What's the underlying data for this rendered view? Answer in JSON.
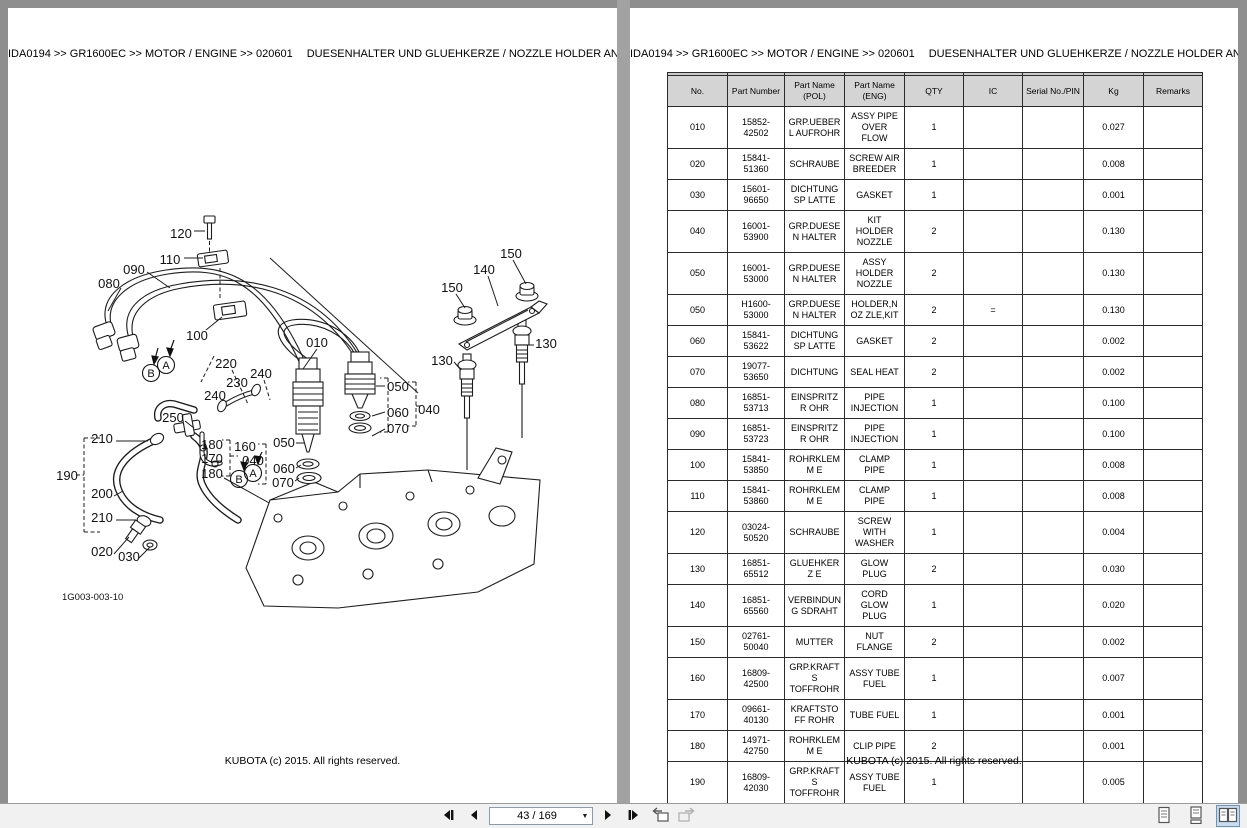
{
  "header": {
    "breadcrumb": "IDA0194 >> GR1600EC >> MOTOR / ENGINE >> 020601",
    "title": "DUESENHALTER UND GLUEHKERZE / NOZZLE HOLDER AND GLOW PLUG"
  },
  "footer": {
    "copyright": "KUBOTA (c) 2015. All rights reserved."
  },
  "diagram": {
    "figure_id": "1G003-003-10",
    "labels": [
      {
        "t": "120",
        "x": 173,
        "y": 225
      },
      {
        "t": "110",
        "x": 162,
        "y": 251
      },
      {
        "t": "090",
        "x": 126,
        "y": 261
      },
      {
        "t": "080",
        "x": 101,
        "y": 275
      },
      {
        "t": "100",
        "x": 189,
        "y": 327
      },
      {
        "t": "010",
        "x": 309,
        "y": 334
      },
      {
        "t": "150",
        "x": 503,
        "y": 245
      },
      {
        "t": "140",
        "x": 476,
        "y": 261
      },
      {
        "t": "150",
        "x": 444,
        "y": 279
      },
      {
        "t": "130",
        "x": 538,
        "y": 335
      },
      {
        "t": "130",
        "x": 434,
        "y": 352
      },
      {
        "t": "220",
        "x": 218,
        "y": 355
      },
      {
        "t": "240",
        "x": 253,
        "y": 365
      },
      {
        "t": "230",
        "x": 229,
        "y": 374
      },
      {
        "t": "240",
        "x": 207,
        "y": 387
      },
      {
        "t": "250",
        "x": 165,
        "y": 409
      },
      {
        "t": "210",
        "x": 94,
        "y": 430
      },
      {
        "t": "190",
        "x": 59,
        "y": 467
      },
      {
        "t": "200",
        "x": 94,
        "y": 485
      },
      {
        "t": "210",
        "x": 94,
        "y": 509
      },
      {
        "t": "020",
        "x": 94,
        "y": 543
      },
      {
        "t": "030",
        "x": 121,
        "y": 548
      },
      {
        "t": "180",
        "x": 204,
        "y": 436
      },
      {
        "t": "160",
        "x": 237,
        "y": 438
      },
      {
        "t": "170",
        "x": 204,
        "y": 450
      },
      {
        "t": "180",
        "x": 204,
        "y": 465
      },
      {
        "t": "040",
        "x": 245,
        "y": 452
      },
      {
        "t": "050",
        "x": 276,
        "y": 434
      },
      {
        "t": "060",
        "x": 276,
        "y": 460
      },
      {
        "t": "070",
        "x": 275,
        "y": 474
      },
      {
        "t": "050",
        "x": 390,
        "y": 378
      },
      {
        "t": "060",
        "x": 390,
        "y": 404
      },
      {
        "t": "040",
        "x": 421,
        "y": 401
      },
      {
        "t": "070",
        "x": 390,
        "y": 420
      },
      {
        "t": "A",
        "x": 158,
        "y": 357,
        "c": true
      },
      {
        "t": "B",
        "x": 143,
        "y": 365,
        "c": true
      },
      {
        "t": "A",
        "x": 245,
        "y": 465,
        "c": true
      },
      {
        "t": "B",
        "x": 231,
        "y": 471,
        "c": true
      }
    ]
  },
  "table": {
    "columns": [
      "No.",
      "Part Number",
      "Part Name (POL)",
      "Part Name (ENG)",
      "QTY",
      "IC",
      "Serial No./PIN",
      "Kg",
      "Remarks"
    ],
    "rows": [
      [
        "010",
        "15852-42502",
        "GRP.UEBERL AUFROHR",
        "ASSY PIPE OVER FLOW",
        "1",
        "",
        "",
        "0.027",
        ""
      ],
      [
        "020",
        "15841-51360",
        "SCHRAUBE",
        "SCREW AIR BREEDER",
        "1",
        "",
        "",
        "0.008",
        ""
      ],
      [
        "030",
        "15601-96650",
        "DICHTUNGSP LATTE",
        "GASKET",
        "1",
        "",
        "",
        "0.001",
        ""
      ],
      [
        "040",
        "16001-53900",
        "GRP.DUESEN HALTER",
        "KIT HOLDER NOZZLE",
        "2",
        "",
        "",
        "0.130",
        ""
      ],
      [
        "050",
        "16001-53000",
        "GRP.DUESEN HALTER",
        "ASSY HOLDER NOZZLE",
        "2",
        "",
        "",
        "0.130",
        ""
      ],
      [
        "050",
        "H1600-53000",
        "GRP.DUESEN HALTER",
        "HOLDER,NOZ ZLE,KIT",
        "2",
        "=",
        "",
        "0.130",
        ""
      ],
      [
        "060",
        "15841-53622",
        "DICHTUNGSP LATTE",
        "GASKET",
        "2",
        "",
        "",
        "0.002",
        ""
      ],
      [
        "070",
        "19077-53650",
        "DICHTUNG",
        "SEAL HEAT",
        "2",
        "",
        "",
        "0.002",
        ""
      ],
      [
        "080",
        "16851-53713",
        "EINSPRITZR OHR",
        "PIPE INJECTION",
        "1",
        "",
        "",
        "0.100",
        ""
      ],
      [
        "090",
        "16851-53723",
        "EINSPRITZR OHR",
        "PIPE INJECTION",
        "1",
        "",
        "",
        "0.100",
        ""
      ],
      [
        "100",
        "15841-53850",
        "ROHRKLEMM E",
        "CLAMP PIPE",
        "1",
        "",
        "",
        "0.008",
        ""
      ],
      [
        "110",
        "15841-53860",
        "ROHRKLEMM E",
        "CLAMP PIPE",
        "1",
        "",
        "",
        "0.008",
        ""
      ],
      [
        "120",
        "03024-50520",
        "SCHRAUBE",
        "SCREW WITH WASHER",
        "1",
        "",
        "",
        "0.004",
        ""
      ],
      [
        "130",
        "16851-65512",
        "GLUEHKERZ E",
        "GLOW PLUG",
        "2",
        "",
        "",
        "0.030",
        ""
      ],
      [
        "140",
        "16851-65560",
        "VERBINDUNG SDRAHT",
        "CORD GLOW PLUG",
        "1",
        "",
        "",
        "0.020",
        ""
      ],
      [
        "150",
        "02761-50040",
        "MUTTER",
        "NUT FLANGE",
        "2",
        "",
        "",
        "0.002",
        ""
      ],
      [
        "160",
        "16809-42500",
        "GRP.KRAFTS TOFFROHR",
        "ASSY TUBE FUEL",
        "1",
        "",
        "",
        "0.007",
        ""
      ],
      [
        "170",
        "09661-40130",
        "KRAFTSTOFF ROHR",
        "TUBE FUEL",
        "1",
        "",
        "",
        "0.001",
        ""
      ],
      [
        "180",
        "14971-42750",
        "ROHRKLEMM E",
        "CLIP PIPE",
        "2",
        "",
        "",
        "0.001",
        ""
      ],
      [
        "190",
        "16809-42030",
        "GRP.KRAFTS TOFFROHR",
        "ASSY TUBE FUEL",
        "1",
        "",
        "",
        "0.005",
        ""
      ]
    ]
  },
  "toolbar": {
    "page_indicator": "43 / 169",
    "icons": {
      "first_page": "first-page-icon",
      "previous_page": "previous-page-icon",
      "page_dropdown": "chevron-down-icon",
      "next_page": "next-page-icon",
      "last_page": "last-page-icon",
      "previous_view": "previous-view-icon",
      "next_view": "next-view-icon",
      "single_page": "single-page-view-icon",
      "continuous": "continuous-view-icon",
      "two_page": "two-page-view-icon"
    }
  },
  "colors": {
    "canvas_bg": "#8e8e8e",
    "page_bg": "#ffffff",
    "table_header_bg": "#d4d4d4",
    "toolbar_bg": "#f1f1f1",
    "selected_view_bg": "#c8dcf0"
  }
}
